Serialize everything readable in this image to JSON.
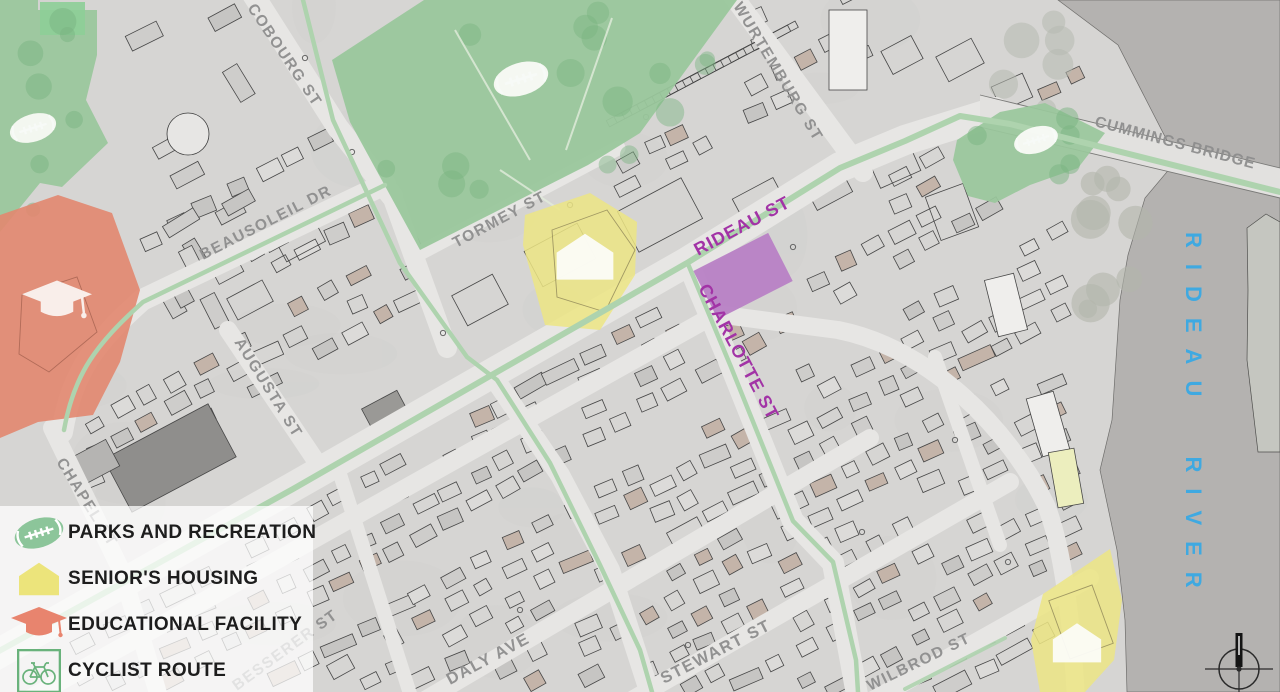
{
  "map": {
    "street_labels": [
      {
        "id": "cobourg",
        "text": "COBOURG ST"
      },
      {
        "id": "beausoleil",
        "text": "BEAUSOLEIL DR"
      },
      {
        "id": "tormey",
        "text": "TORMEY ST"
      },
      {
        "id": "wurtemburg",
        "text": "WURTEMBURG ST"
      },
      {
        "id": "cummings",
        "text": "CUMMINGS BRIDGE"
      },
      {
        "id": "augusta",
        "text": "AUGUSTA ST"
      },
      {
        "id": "chapel",
        "text": "CHAPEL ST"
      },
      {
        "id": "besserer",
        "text": "BESSERER ST"
      },
      {
        "id": "daly",
        "text": "DALY AVE"
      },
      {
        "id": "stewart",
        "text": "STEWART ST"
      },
      {
        "id": "wilbrod",
        "text": "WILBROD ST"
      }
    ],
    "highlight_labels": [
      {
        "id": "rideau",
        "text": "RIDEAU ST"
      },
      {
        "id": "charlotte",
        "text": "CHARLOTTE ST"
      }
    ],
    "water_label": {
      "text": "RIDEAU RIVER"
    }
  },
  "legend": {
    "items": [
      {
        "icon": "rugby-ball-icon",
        "label": "PARKS AND RECREATION"
      },
      {
        "icon": "house-icon",
        "label": "SENIOR'S HOUSING"
      },
      {
        "icon": "graduation-cap-icon",
        "label": "EDUCATIONAL FACILITY"
      },
      {
        "icon": "bicycle-icon",
        "label": "CYCLIST ROUTE"
      }
    ]
  },
  "colors": {
    "park_green": "#9ac79c",
    "tree_green": "#7ab381",
    "housing_yellow": "#ece584",
    "education_red": "#e2876f",
    "building_purple": "#b77ec4",
    "route_green": "#aed3ae",
    "street_purple": "#a233a6",
    "river_blue_text": "#3fa9e1",
    "water_gray": "#b4b2b0",
    "land_gray": "#d6d5d3",
    "street_gray": "#e7e6e4",
    "legend_ball_green": "#8cc59a",
    "legend_house_yellow": "#ece47b",
    "legend_cap_red": "#e8846e",
    "legend_bike_green": "#69b27b"
  }
}
